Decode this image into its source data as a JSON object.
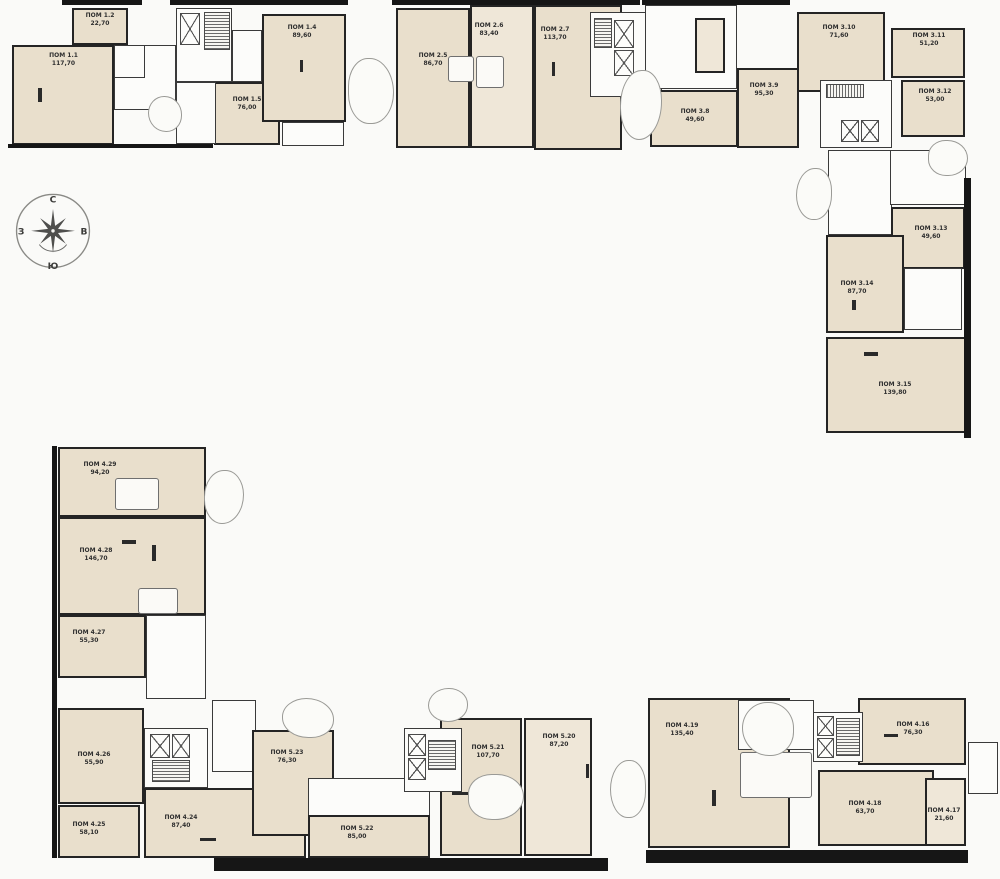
{
  "page": {
    "background": "#fafaf8"
  },
  "colors": {
    "room_fill": "#e9dfcc",
    "room_fill_light": "#efe7d8",
    "wall": "#1d1d1d",
    "thin_line": "#8a8a8a",
    "label_text": "#2f2f2f"
  },
  "compass": {
    "north": "С",
    "east": "В",
    "south": "Ю",
    "west": "З"
  },
  "units": {
    "u1_1": {
      "name": "ПОМ 1.1",
      "area": "117,70"
    },
    "u1_2": {
      "name": "ПОМ 1.2",
      "area": "22,70"
    },
    "u1_4": {
      "name": "ПОМ 1.4",
      "area": "89,60"
    },
    "u1_5": {
      "name": "ПОМ 1.5",
      "area": "76,00"
    },
    "u2_5": {
      "name": "ПОМ 2.5",
      "area": "86,70"
    },
    "u2_6": {
      "name": "ПОМ 2.6",
      "area": "83,40"
    },
    "u2_7": {
      "name": "ПОМ 2.7",
      "area": "113,70"
    },
    "u3_8": {
      "name": "ПОМ 3.8",
      "area": "49,60"
    },
    "u3_9": {
      "name": "ПОМ 3.9",
      "area": "95,30"
    },
    "u3_10": {
      "name": "ПОМ 3.10",
      "area": "71,60"
    },
    "u3_11": {
      "name": "ПОМ 3.11",
      "area": "51,20"
    },
    "u3_12": {
      "name": "ПОМ 3.12",
      "area": "53,00"
    },
    "u3_13": {
      "name": "ПОМ 3.13",
      "area": "49,60"
    },
    "u3_14": {
      "name": "ПОМ 3.14",
      "area": "87,70"
    },
    "u3_15": {
      "name": "ПОМ 3.15",
      "area": "139,80"
    },
    "u4_16": {
      "name": "ПОМ 4.16",
      "area": "76,30"
    },
    "u4_17": {
      "name": "ПОМ 4.17",
      "area": "21,60"
    },
    "u4_18": {
      "name": "ПОМ 4.18",
      "area": "63,70"
    },
    "u4_19": {
      "name": "ПОМ 4.19",
      "area": "135,40"
    },
    "u4_24": {
      "name": "ПОМ 4.24",
      "area": "87,40"
    },
    "u4_25": {
      "name": "ПОМ 4.25",
      "area": "58,10"
    },
    "u4_26": {
      "name": "ПОМ 4.26",
      "area": "55,90"
    },
    "u4_27": {
      "name": "ПОМ 4.27",
      "area": "55,30"
    },
    "u4_28": {
      "name": "ПОМ 4.28",
      "area": "146,70"
    },
    "u4_29": {
      "name": "ПОМ 4.29",
      "area": "94,20"
    },
    "u5_20": {
      "name": "ПОМ 5.20",
      "area": "87,20"
    },
    "u5_21": {
      "name": "ПОМ 5.21",
      "area": "107,70"
    },
    "u5_22": {
      "name": "ПОМ 5.22",
      "area": "85,00"
    },
    "u5_23": {
      "name": "ПОМ 5.23",
      "area": "76,30"
    }
  }
}
